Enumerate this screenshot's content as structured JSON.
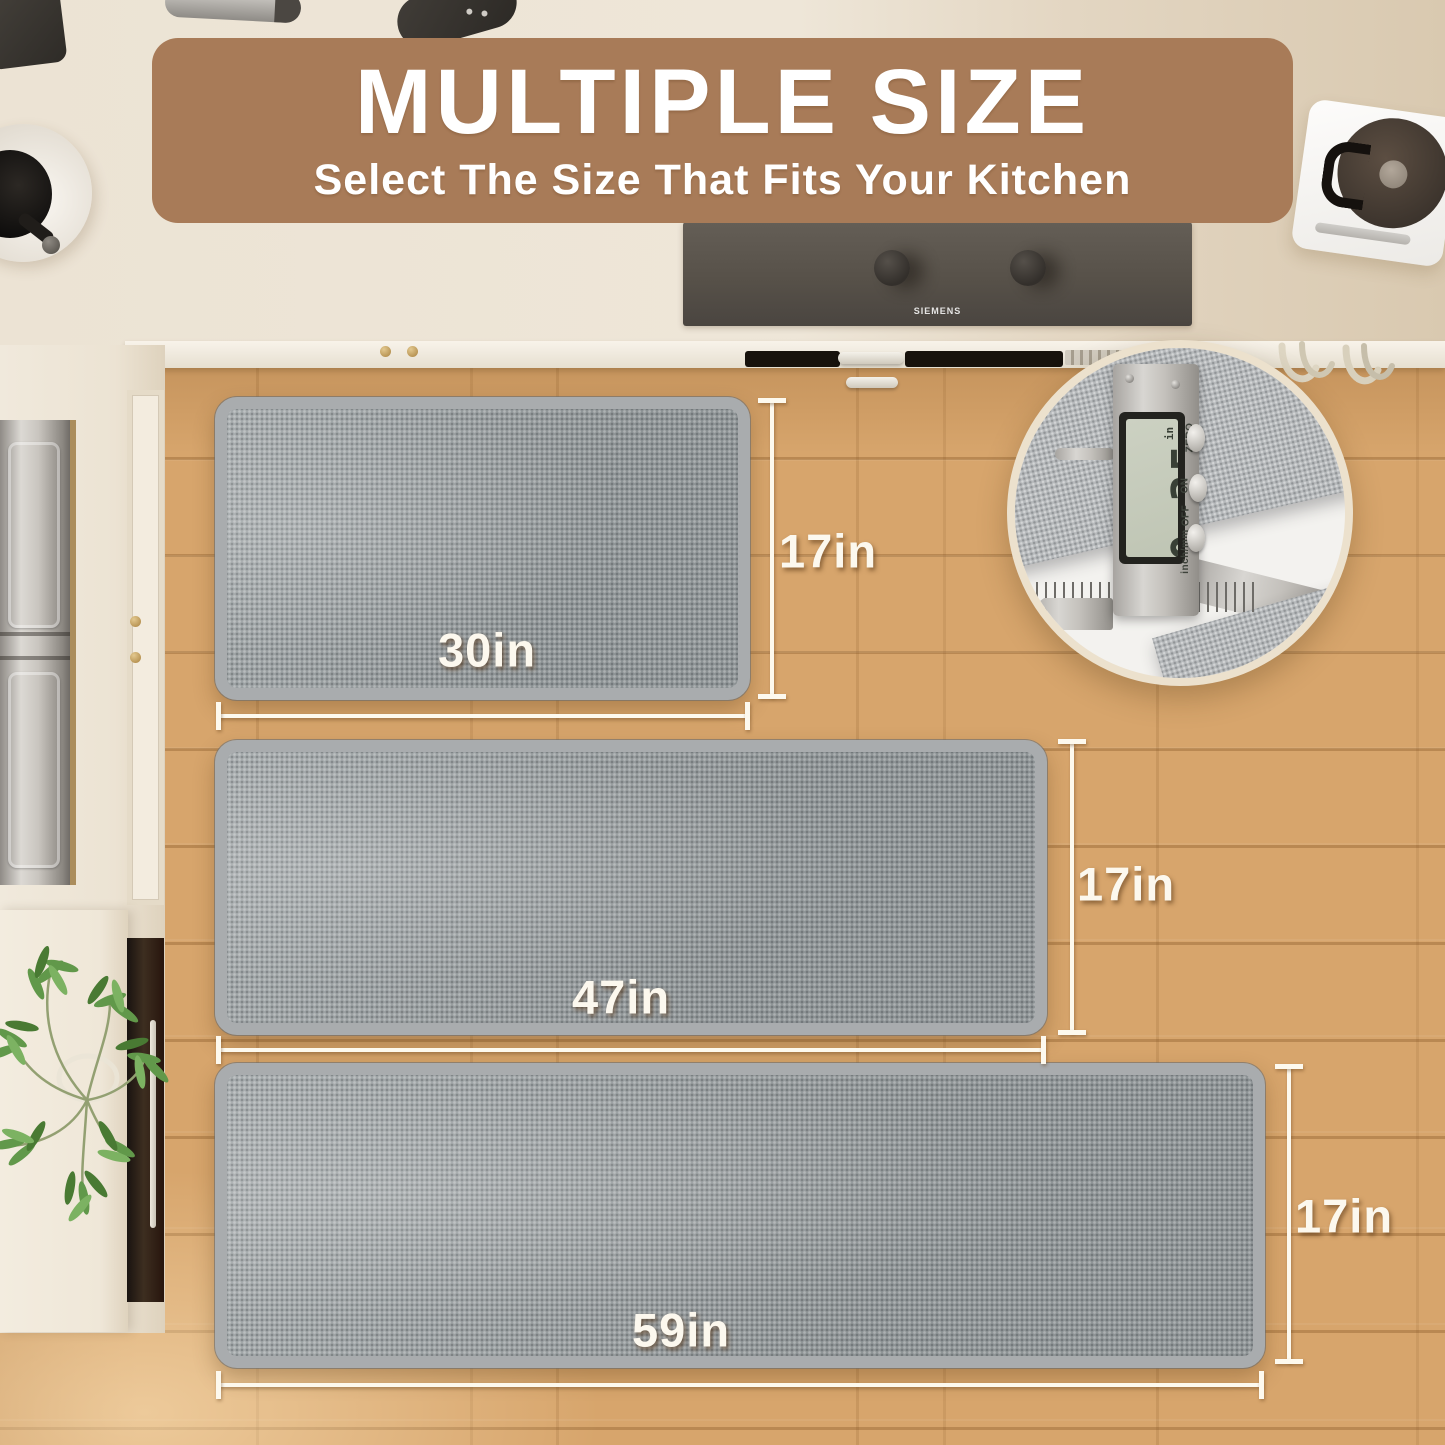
{
  "banner": {
    "title": "MULTIPLE SIZE",
    "subtitle": "Select The Size That Fits Your Kitchen",
    "bg_color": "#a87b58",
    "text_color": "#ffffff"
  },
  "mats": [
    {
      "name": "small",
      "width_label": "30in",
      "height_label": "17in"
    },
    {
      "name": "medium",
      "width_label": "47in",
      "height_label": "17in"
    },
    {
      "name": "large",
      "width_label": "59in",
      "height_label": "17in"
    }
  ],
  "inset": {
    "caliper_reading": "0.35",
    "caliper_unit": "in",
    "button_labels": [
      "ZERO",
      "ON",
      "OFF"
    ],
    "mode_label": "inch/mm"
  },
  "appliances": {
    "cooktop_brand": "SIEMENS"
  },
  "colors": {
    "banner_bg": "#a87b58",
    "dimension_white": "#fdf9ee",
    "mat_gray": "#9aa0a2",
    "mat_border": "#a9acae",
    "floor_wood": "#d7a56c",
    "countertop": "#ece3d4"
  }
}
